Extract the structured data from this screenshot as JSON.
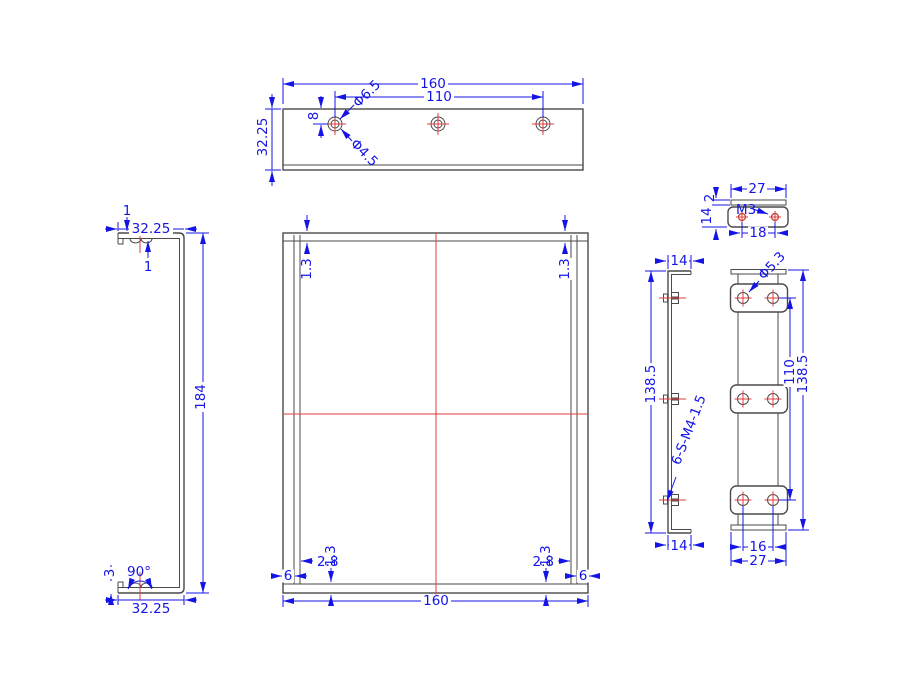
{
  "drawing": {
    "type": "engineering-cad-drawing",
    "background": "#ffffff",
    "colors": {
      "dimension": "#1414e6",
      "outline": "#4a4a4a",
      "centerline": "#e23b3b",
      "detail_hole": "#c0392b"
    },
    "views": {
      "top": {
        "label": "top-view",
        "dims": {
          "width": "160",
          "hole_span": "110",
          "height": "32.25",
          "hole_edge": "8",
          "counterbore": "Φ6.5",
          "hole_dia": "Φ4.5"
        }
      },
      "left": {
        "label": "left-side-view",
        "dims": {
          "flange_top": "32.25",
          "thickness": "1",
          "lip": "1",
          "height": "184",
          "angle": "90°",
          "emboss": "3",
          "flange_bottom": "32.25"
        }
      },
      "front": {
        "label": "front-view",
        "dims": {
          "gap_top_left": "1.3",
          "gap_top_right": "1.3",
          "gap_bottom_left": "1.3",
          "gap_bottom_right": "1.3",
          "inset_left": "2.8",
          "inset_right": "2.8",
          "edge_left": "6",
          "edge_right": "6",
          "width": "160"
        }
      },
      "fastener": {
        "label": "fastener-top-view",
        "dims": {
          "width": "27",
          "thread": "M3",
          "hole_span": "18",
          "thickness": "2",
          "depth": "14"
        }
      },
      "side": {
        "label": "side-profile-view",
        "dims": {
          "flange_top": "14",
          "height": "138.5",
          "stud_note": "6-S-M4-1.5",
          "flange_bottom": "14"
        }
      },
      "plate": {
        "label": "stud-plate-view",
        "dims": {
          "hole_dia": "Φ5.3",
          "hole_span": "110",
          "height": "138.5",
          "hole_pitch": "16",
          "width": "27"
        }
      }
    }
  }
}
